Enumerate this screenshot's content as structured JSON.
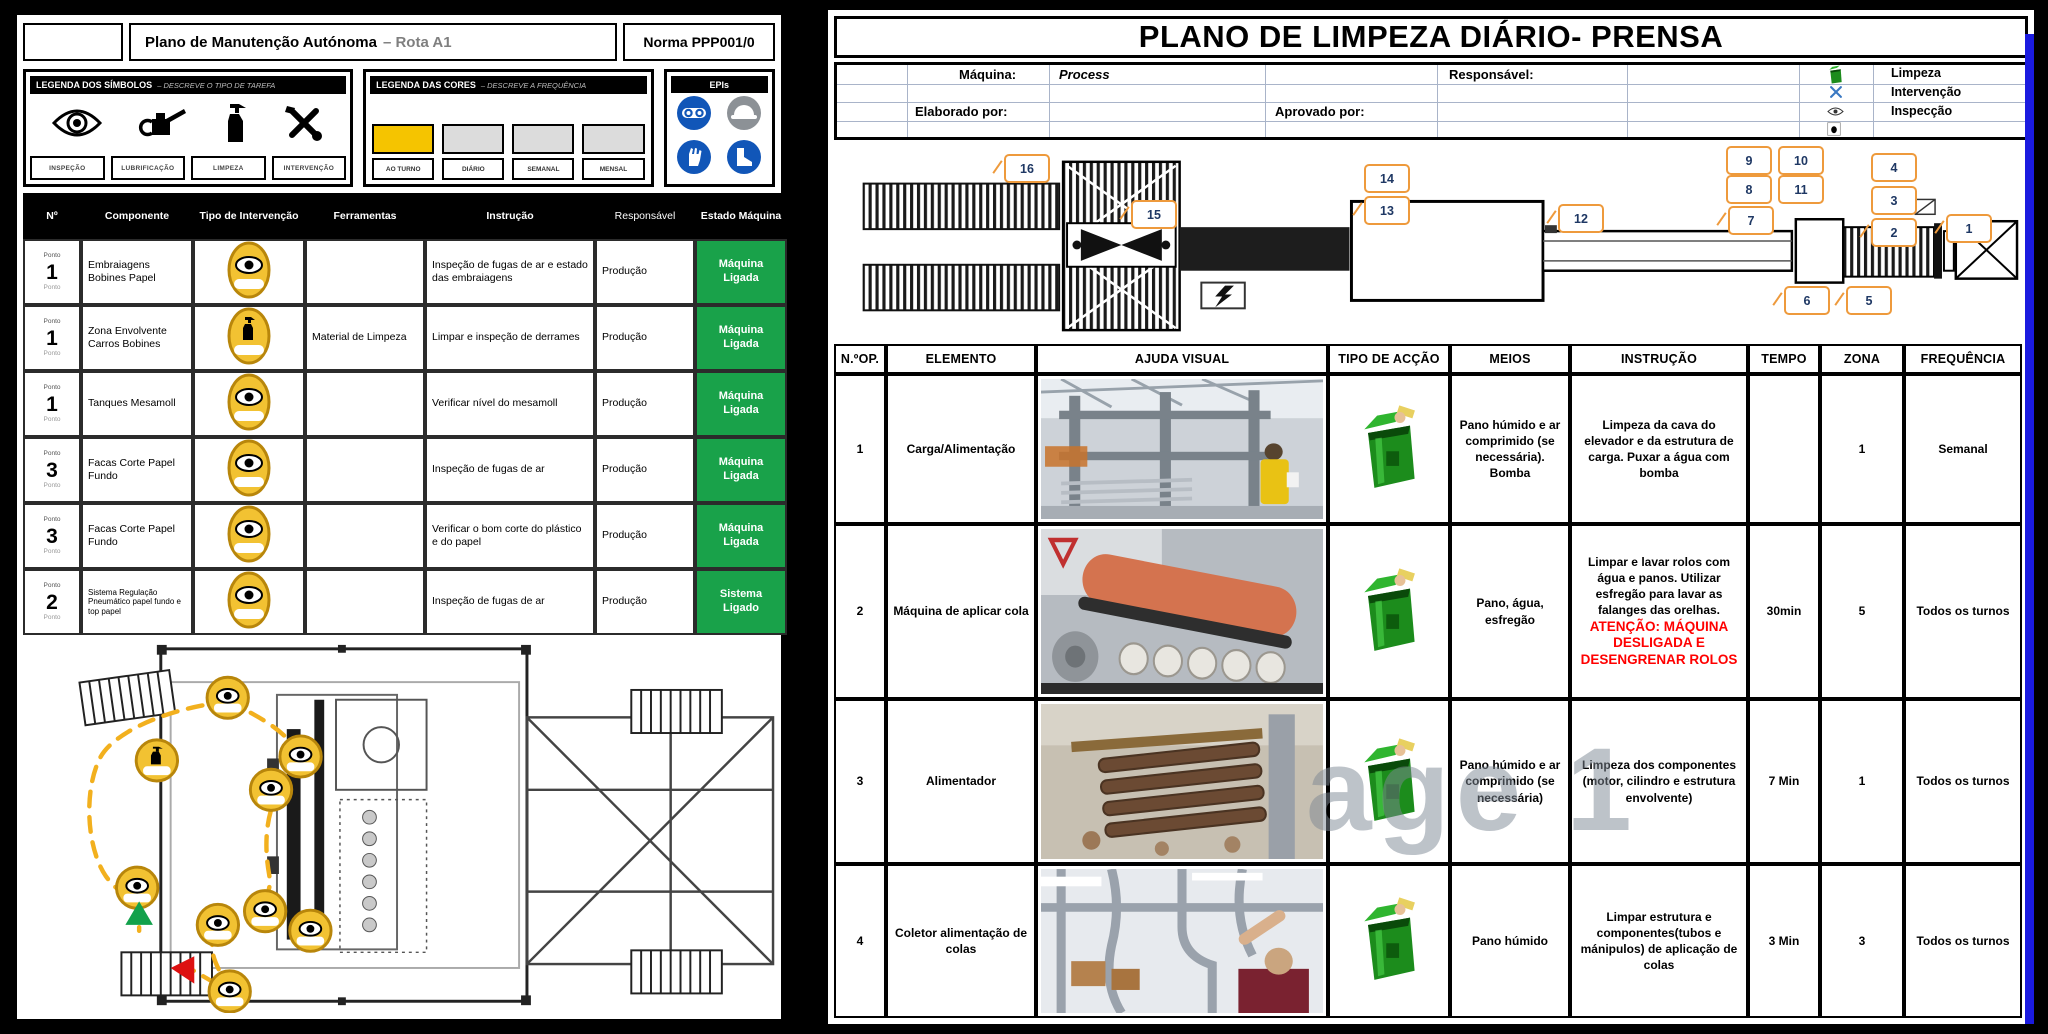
{
  "left": {
    "header": {
      "title_main": "Plano de Manutenção Autónoma",
      "title_sub": "– Rota A1",
      "norma": "Norma PPP001/0"
    },
    "legend_symbols": {
      "title": "LEGENDA DOS SÍMBOLOS",
      "subtitle": "– DESCREVE O TIPO DE TAREFA",
      "labels": [
        "INSPEÇÃO",
        "LUBRIFICAÇÃO",
        "LIMPEZA",
        "INTERVENÇÃO"
      ]
    },
    "legend_colors": {
      "title": "LEGENDA DAS CORES",
      "subtitle": "– DESCREVE A FREQUÊNCIA",
      "items": [
        {
          "label": "AO TURNO",
          "color": "#F5C400"
        },
        {
          "label": "DIÁRIO",
          "color": "#DCDCDC"
        },
        {
          "label": "SEMANAL",
          "color": "#DCDCDC"
        },
        {
          "label": "MENSAL",
          "color": "#DCDCDC"
        }
      ]
    },
    "epis": {
      "title": "EPIs"
    },
    "table": {
      "headers": [
        "Nº",
        "Componente",
        "Tipo de Intervenção",
        "Ferramentas",
        "Instrução",
        "Responsável",
        "Estado Máquina"
      ],
      "rows": [
        {
          "ponto": "Ponto",
          "num": "1",
          "sub": "Ponto",
          "componente": "Embraiagens Bobines Papel",
          "ferramentas": "",
          "instrucao": "Inspeção de fugas de ar e estado das embraiagens",
          "responsavel": "Produção",
          "estado": "Máquina Ligada"
        },
        {
          "ponto": "Ponto",
          "num": "1",
          "sub": "Ponto",
          "componente": "Zona Envolvente Carros Bobines",
          "ferramentas": "Material de Limpeza",
          "instrucao": "Limpar e inspeção de derrames",
          "responsavel": "Produção",
          "estado": "Máquina Ligada"
        },
        {
          "ponto": "Ponto",
          "num": "1",
          "sub": "Ponto",
          "componente": "Tanques Mesamoll",
          "ferramentas": "",
          "instrucao": "Verificar nível do mesamoll",
          "responsavel": "Produção",
          "estado": "Máquina Ligada"
        },
        {
          "ponto": "Ponto",
          "num": "3",
          "sub": "Ponto",
          "componente": "Facas Corte Papel Fundo",
          "ferramentas": "",
          "instrucao": "Inspeção de fugas de ar",
          "responsavel": "Produção",
          "estado": "Máquina Ligada"
        },
        {
          "ponto": "Ponto",
          "num": "3",
          "sub": "Ponto",
          "componente": "Facas Corte Papel Fundo",
          "ferramentas": "",
          "instrucao": "Verificar o bom corte do plástico e do papel",
          "responsavel": "Produção",
          "estado": "Máquina Ligada"
        },
        {
          "ponto": "Ponto",
          "num": "2",
          "sub": "Ponto",
          "componente": "Sistema Regulação Pneumático papel fundo e top papel",
          "ferramentas": "",
          "instrucao": "Inspeção de fugas de ar",
          "responsavel": "Produção",
          "estado": "Sistema Ligado"
        }
      ]
    }
  },
  "right": {
    "title": "PLANO DE LIMPEZA DIÁRIO- PRENSA",
    "info": {
      "maquina_label": "Máquina:",
      "maquina_value": "Process",
      "responsavel_label": "Responsável:",
      "elaborado_label": "Elaborado por:",
      "aprovado_label": "Aprovado por:",
      "legend_labels": [
        "Limpeza",
        "Intervenção",
        "Inspecção"
      ]
    },
    "diagram": {
      "callouts": [
        "1",
        "2",
        "3",
        "4",
        "5",
        "6",
        "7",
        "8",
        "9",
        "10",
        "11",
        "12",
        "13",
        "14",
        "15",
        "16"
      ]
    },
    "table": {
      "headers": [
        "N.ºOP.",
        "ELEMENTO",
        "AJUDA VISUAL",
        "TIPO DE ACÇÃO",
        "MEIOS",
        "INSTRUÇÃO",
        "TEMPO",
        "ZONA",
        "FREQUÊNCIA"
      ],
      "watermark": "age 1",
      "rows": [
        {
          "op": "1",
          "elemento": "Carga/Alimentação",
          "meios": "Pano húmido e ar comprimido (se necessária). Bomba",
          "instrucao": "Limpeza da cava do elevador e da estrutura de carga. Puxar a água com bomba",
          "instrucao_alerta": "",
          "tempo": "",
          "zona": "1",
          "freq": "Semanal"
        },
        {
          "op": "2",
          "elemento": "Máquina de aplicar cola",
          "meios": "Pano, água, esfregão",
          "instrucao": "Limpar e lavar rolos com água e panos. Utilizar esfregão para lavar as falanges das orelhas.",
          "instrucao_alerta": "ATENÇÃO: MÁQUINA DESLIGADA E DESENGRENAR ROLOS",
          "tempo": "30min",
          "zona": "5",
          "freq": "Todos os turnos"
        },
        {
          "op": "3",
          "elemento": "Alimentador",
          "meios": "Pano húmido e ar comprimido (se necessária)",
          "instrucao": "Limpeza dos componentes (motor, cilindro e estrutura envolvente)",
          "instrucao_alerta": "",
          "tempo": "7 Min",
          "zona": "1",
          "freq": "Todos os turnos"
        },
        {
          "op": "4",
          "elemento": "Coletor alimentação de colas",
          "meios": "Pano húmido",
          "instrucao": "Limpar estrutura e componentes(tubos e mánipulos) de aplicação de colas",
          "instrucao_alerta": "",
          "tempo": "3 Min",
          "zona": "3",
          "freq": "Todos os turnos"
        }
      ]
    },
    "colors": {
      "green_state": "#19A24A",
      "callout_border": "#EE9A3C",
      "alert_red": "#FF0000",
      "bin_green": "#1C8C1C"
    }
  }
}
